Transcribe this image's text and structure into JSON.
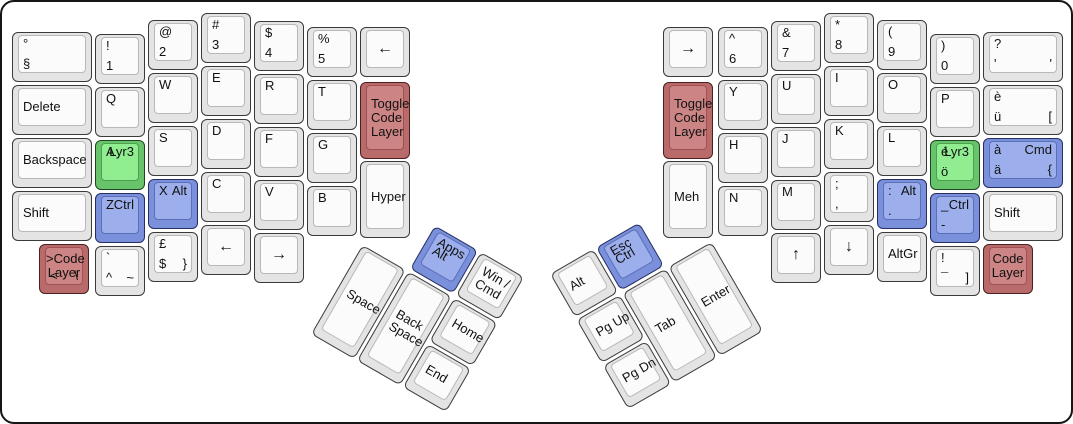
{
  "canvas": {
    "width": 1073,
    "height": 424,
    "background": "#ffffff",
    "border_color": "#151515"
  },
  "colors": {
    "white": {
      "base": "#e4e4e4",
      "top": "#fbfbfb",
      "border": "#3a3a3a",
      "top_border": "#b8b8b8"
    },
    "green": {
      "base": "#68c46a",
      "top": "#90ee90",
      "border": "#1e4620",
      "top_border": "#4da04f"
    },
    "blue": {
      "base": "#7a90da",
      "top": "#9cafec",
      "border": "#252f63",
      "top_border": "#5a6fb8"
    },
    "red": {
      "base": "#b96a6a",
      "top": "#cc8484",
      "border": "#4e1f1f",
      "top_border": "#a05050"
    }
  },
  "groups": [
    {
      "name": "left-main",
      "x": 0,
      "y": 0,
      "rot": 0,
      "keys": [
        {
          "name": "key-section",
          "x": 10,
          "y": 30,
          "w": 80,
          "legends": {
            "tl": "°",
            "bl": "§"
          }
        },
        {
          "name": "key-delete",
          "x": 10,
          "y": 83,
          "w": 80,
          "legends": {
            "ml": "Delete"
          }
        },
        {
          "name": "key-backspace",
          "x": 10,
          "y": 136,
          "w": 80,
          "legends": {
            "ml": "Backspace"
          }
        },
        {
          "name": "key-shift-left",
          "x": 10,
          "y": 189,
          "w": 80,
          "legends": {
            "ml": "Shift"
          }
        },
        {
          "name": "key-code-layer-left",
          "x": 37,
          "y": 242,
          "color": "red",
          "align": "center",
          "legends": {
            "lines": [
              ">Code",
              "Layer"
            ],
            "bl": "<",
            "br": "\\"
          }
        },
        {
          "name": "key-1",
          "x": 93,
          "y": 32,
          "legends": {
            "tl": "!",
            "bl": "1"
          }
        },
        {
          "name": "key-q",
          "x": 93,
          "y": 85,
          "legends": {
            "tl": "Q"
          }
        },
        {
          "name": "key-a-lyr3",
          "x": 93,
          "y": 138,
          "color": "green",
          "legends": {
            "tl": "A",
            "tr": "Lyr3"
          }
        },
        {
          "name": "key-z-ctrl",
          "x": 93,
          "y": 191,
          "color": "blue",
          "legends": {
            "tl": "Z",
            "tr": "Ctrl"
          }
        },
        {
          "name": "key-grave",
          "x": 93,
          "y": 244,
          "legends": {
            "tl": "`",
            "bl": "^",
            "br": "~"
          }
        },
        {
          "name": "key-2",
          "x": 146,
          "y": 18,
          "legends": {
            "tl": "@",
            "bl": "2"
          }
        },
        {
          "name": "key-w",
          "x": 146,
          "y": 71,
          "legends": {
            "tl": "W"
          }
        },
        {
          "name": "key-s",
          "x": 146,
          "y": 124,
          "legends": {
            "tl": "S"
          }
        },
        {
          "name": "key-x-alt",
          "x": 146,
          "y": 177,
          "color": "blue",
          "legends": {
            "tl": "X",
            "tr": "Alt"
          }
        },
        {
          "name": "key-pound",
          "x": 146,
          "y": 230,
          "legends": {
            "tl": "£",
            "bl": "$",
            "br": "}"
          }
        },
        {
          "name": "key-3",
          "x": 199,
          "y": 11,
          "legends": {
            "tl": "#",
            "bl": "3"
          }
        },
        {
          "name": "key-e",
          "x": 199,
          "y": 64,
          "legends": {
            "tl": "E"
          }
        },
        {
          "name": "key-d",
          "x": 199,
          "y": 117,
          "legends": {
            "tl": "D"
          }
        },
        {
          "name": "key-c",
          "x": 199,
          "y": 170,
          "legends": {
            "tl": "C"
          }
        },
        {
          "name": "key-arrow-left-bottom",
          "x": 199,
          "y": 223,
          "arrow": true,
          "legends": {
            "center": "←"
          }
        },
        {
          "name": "key-4",
          "x": 252,
          "y": 19,
          "legends": {
            "tl": "$",
            "bl": "4"
          }
        },
        {
          "name": "key-r",
          "x": 252,
          "y": 72,
          "legends": {
            "tl": "R"
          }
        },
        {
          "name": "key-f",
          "x": 252,
          "y": 125,
          "legends": {
            "tl": "F"
          }
        },
        {
          "name": "key-v",
          "x": 252,
          "y": 178,
          "legends": {
            "tl": "V"
          }
        },
        {
          "name": "key-arrow-right-bottom",
          "x": 252,
          "y": 231,
          "arrow": true,
          "legends": {
            "center": "→"
          }
        },
        {
          "name": "key-5",
          "x": 305,
          "y": 25,
          "legends": {
            "tl": "%",
            "bl": "5"
          }
        },
        {
          "name": "key-t",
          "x": 305,
          "y": 78,
          "legends": {
            "tl": "T"
          }
        },
        {
          "name": "key-g",
          "x": 305,
          "y": 131,
          "legends": {
            "tl": "G"
          }
        },
        {
          "name": "key-b",
          "x": 305,
          "y": 184,
          "legends": {
            "tl": "B"
          }
        },
        {
          "name": "key-arrow-left-inner",
          "x": 358,
          "y": 25,
          "arrow": true,
          "legends": {
            "center": "←"
          }
        },
        {
          "name": "key-toggle-code-layer-left",
          "x": 358,
          "y": 80,
          "h": 77,
          "color": "red",
          "legends": {
            "lines": [
              "Toggle",
              "Code",
              "Layer"
            ]
          }
        },
        {
          "name": "key-hyper",
          "x": 358,
          "y": 159,
          "h": 77,
          "legends": {
            "ml": "Hyper"
          }
        }
      ]
    },
    {
      "name": "left-thumb",
      "x": 386.5,
      "y": 197,
      "rot": 30,
      "keys": [
        {
          "name": "key-apps-alt",
          "x": 53,
          "y": 0,
          "color": "blue",
          "legends": {
            "tl": "Apps",
            "ml": "Alt"
          }
        },
        {
          "name": "key-win-cmd",
          "x": 106,
          "y": 0,
          "legends": {
            "lines": [
              "Win /",
              "Cmd"
            ]
          }
        },
        {
          "name": "key-space",
          "x": 0,
          "y": 53,
          "h": 103,
          "legends": {
            "ml": "Space"
          }
        },
        {
          "name": "key-backspace-thumb",
          "x": 53,
          "y": 53,
          "h": 103,
          "legends": {
            "lines": [
              "Back",
              "Space"
            ]
          }
        },
        {
          "name": "key-home",
          "x": 106,
          "y": 53,
          "legends": {
            "ml": "Home"
          }
        },
        {
          "name": "key-end",
          "x": 106,
          "y": 106,
          "legends": {
            "ml": "End"
          }
        }
      ]
    },
    {
      "name": "right-main",
      "x": 0,
      "y": 0,
      "rot": 0,
      "keys": [
        {
          "name": "key-arrow-right-inner",
          "x": 661,
          "y": 25,
          "arrow": true,
          "legends": {
            "center": "→"
          }
        },
        {
          "name": "key-toggle-code-layer-right",
          "x": 661,
          "y": 80,
          "h": 77,
          "color": "red",
          "legends": {
            "lines": [
              "Toggle",
              "Code",
              "Layer"
            ]
          }
        },
        {
          "name": "key-meh",
          "x": 661,
          "y": 159,
          "h": 77,
          "legends": {
            "ml": "Meh"
          }
        },
        {
          "name": "key-6",
          "x": 716,
          "y": 25,
          "legends": {
            "tl": "^",
            "bl": "6"
          }
        },
        {
          "name": "key-y",
          "x": 716,
          "y": 78,
          "legends": {
            "tl": "Y"
          }
        },
        {
          "name": "key-h",
          "x": 716,
          "y": 131,
          "legends": {
            "tl": "H"
          }
        },
        {
          "name": "key-n",
          "x": 716,
          "y": 184,
          "legends": {
            "tl": "N"
          }
        },
        {
          "name": "key-7",
          "x": 769,
          "y": 19,
          "legends": {
            "tl": "&",
            "bl": "7"
          }
        },
        {
          "name": "key-u",
          "x": 769,
          "y": 72,
          "legends": {
            "tl": "U"
          }
        },
        {
          "name": "key-j",
          "x": 769,
          "y": 125,
          "legends": {
            "tl": "J"
          }
        },
        {
          "name": "key-m",
          "x": 769,
          "y": 178,
          "legends": {
            "tl": "M"
          }
        },
        {
          "name": "key-arrow-up",
          "x": 769,
          "y": 231,
          "arrow": true,
          "legends": {
            "center": "↑"
          }
        },
        {
          "name": "key-8",
          "x": 822,
          "y": 11,
          "legends": {
            "tl": "*",
            "bl": "8"
          }
        },
        {
          "name": "key-i",
          "x": 822,
          "y": 64,
          "legends": {
            "tl": "I"
          }
        },
        {
          "name": "key-k",
          "x": 822,
          "y": 117,
          "legends": {
            "tl": "K"
          }
        },
        {
          "name": "key-semicolon",
          "x": 822,
          "y": 170,
          "legends": {
            "tl": ";",
            "bl": ","
          }
        },
        {
          "name": "key-arrow-down",
          "x": 822,
          "y": 223,
          "arrow": true,
          "legends": {
            "center": "↓"
          }
        },
        {
          "name": "key-9",
          "x": 875,
          "y": 18,
          "legends": {
            "tl": "(",
            "bl": "9"
          }
        },
        {
          "name": "key-o",
          "x": 875,
          "y": 71,
          "legends": {
            "tl": "O"
          }
        },
        {
          "name": "key-l",
          "x": 875,
          "y": 124,
          "legends": {
            "tl": "L"
          }
        },
        {
          "name": "key-colon-alt",
          "x": 875,
          "y": 177,
          "color": "blue",
          "legends": {
            "tl": ":",
            "tr": "Alt",
            "bl": "."
          }
        },
        {
          "name": "key-altgr",
          "x": 875,
          "y": 230,
          "legends": {
            "ml": "AltGr"
          }
        },
        {
          "name": "key-0",
          "x": 928,
          "y": 32,
          "legends": {
            "tl": ")",
            "bl": "0"
          }
        },
        {
          "name": "key-p",
          "x": 928,
          "y": 85,
          "legends": {
            "tl": "P"
          }
        },
        {
          "name": "key-e-acute-lyr3",
          "x": 928,
          "y": 138,
          "color": "green",
          "legends": {
            "tl": "é",
            "tr": "Lyr3",
            "bl": "ö"
          }
        },
        {
          "name": "key-underscore-ctrl",
          "x": 928,
          "y": 191,
          "color": "blue",
          "legends": {
            "tl": "_",
            "tr": "Ctrl",
            "bl": "-"
          }
        },
        {
          "name": "key-exclamation",
          "x": 928,
          "y": 244,
          "legends": {
            "tl": "!",
            "bl": "¯",
            "br": "]"
          }
        },
        {
          "name": "key-apostrophe",
          "x": 981,
          "y": 30,
          "w": 80,
          "legends": {
            "tl": "?",
            "bl": "'",
            "br": "'"
          }
        },
        {
          "name": "key-e-grave",
          "x": 981,
          "y": 83,
          "w": 80,
          "legends": {
            "tl": "è",
            "bl": "ü",
            "br": "["
          }
        },
        {
          "name": "key-a-grave-cmd",
          "x": 981,
          "y": 136,
          "w": 80,
          "color": "blue",
          "legends": {
            "tl": "à",
            "tr": "Cmd",
            "bl": "ä",
            "br": "{"
          }
        },
        {
          "name": "key-shift-right",
          "x": 981,
          "y": 189,
          "w": 80,
          "legends": {
            "ml": "Shift"
          }
        },
        {
          "name": "key-code-layer-right",
          "x": 981,
          "y": 242,
          "color": "red",
          "align": "center",
          "legends": {
            "lines": [
              "Code",
              "Layer"
            ]
          }
        }
      ]
    },
    {
      "name": "right-thumb",
      "x": 548,
      "y": 272,
      "rot": -30,
      "keys": [
        {
          "name": "key-alt-thumb",
          "x": 0,
          "y": 0,
          "legends": {
            "ml": "Alt"
          }
        },
        {
          "name": "key-esc-ctrl",
          "x": 53,
          "y": 0,
          "color": "blue",
          "legends": {
            "tl": "Esc",
            "ml": "Ctrl"
          }
        },
        {
          "name": "key-pgup",
          "x": 0,
          "y": 53,
          "legends": {
            "ml": "Pg Up"
          }
        },
        {
          "name": "key-pgdn",
          "x": 0,
          "y": 106,
          "legends": {
            "ml": "Pg Dn"
          }
        },
        {
          "name": "key-tab",
          "x": 53,
          "y": 53,
          "h": 103,
          "legends": {
            "ml": "Tab"
          }
        },
        {
          "name": "key-enter",
          "x": 106,
          "y": 53,
          "h": 103,
          "legends": {
            "ml": "Enter"
          }
        }
      ]
    }
  ]
}
